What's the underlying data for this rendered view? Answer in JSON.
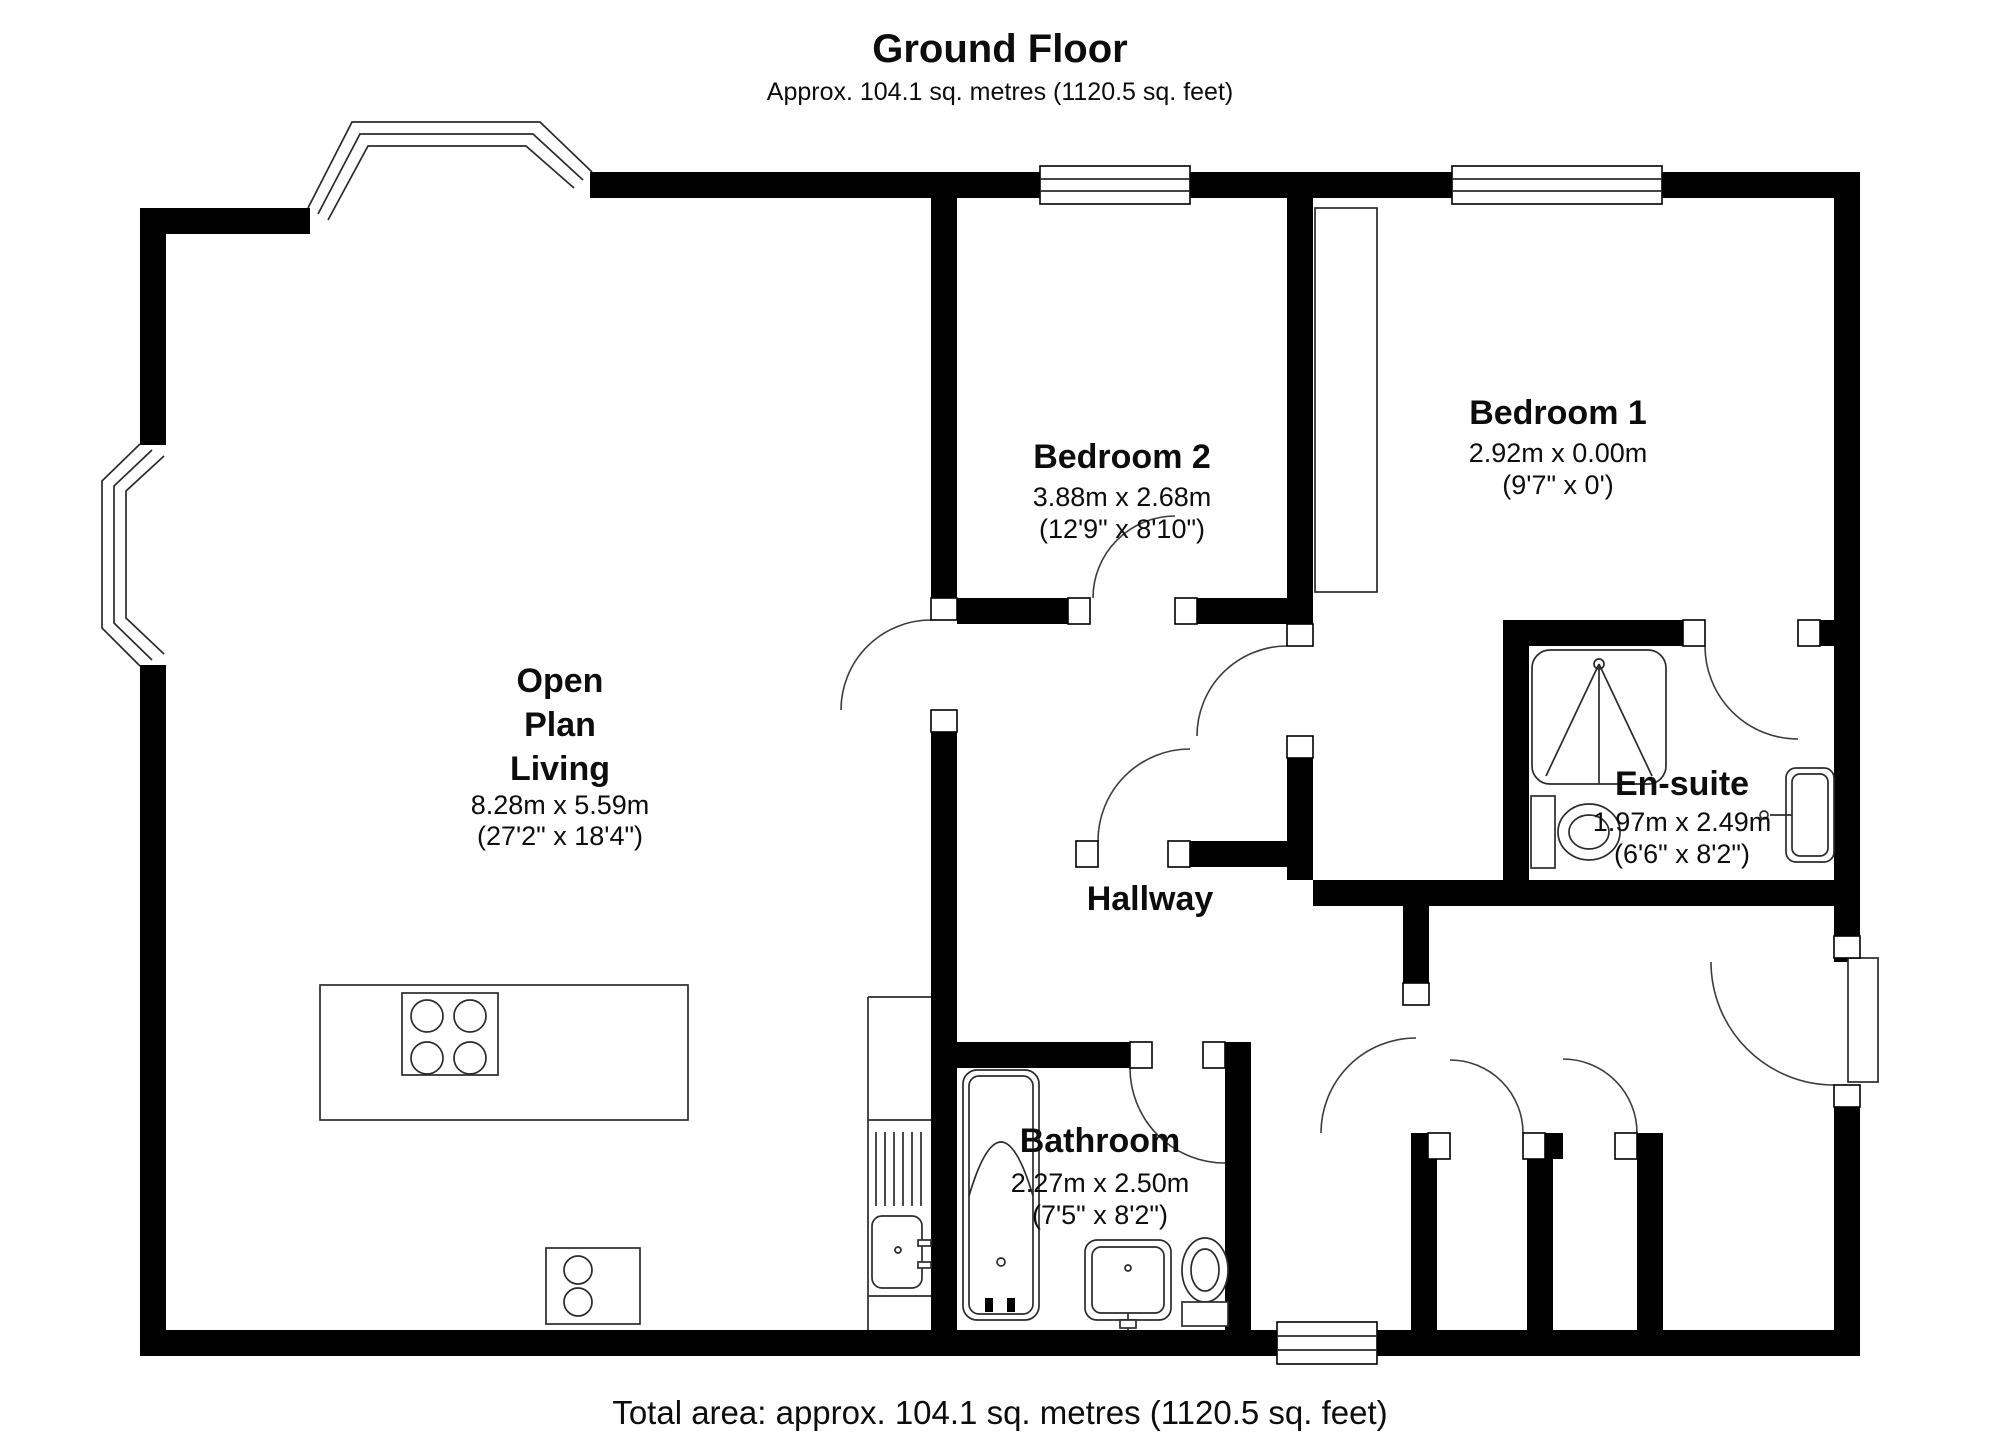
{
  "title": {
    "heading": "Ground Floor",
    "subtitle": "Approx. 104.1 sq. metres (1120.5 sq. feet)"
  },
  "footer": {
    "total_area": "Total area: approx. 104.1 sq. metres (1120.5 sq. feet)"
  },
  "rooms": {
    "open_plan_living": {
      "name_line1": "Open",
      "name_line2": "Plan",
      "name_line3": "Living",
      "dims_metric": "8.28m x 5.59m",
      "dims_imperial": "(27'2\" x 18'4\")"
    },
    "bedroom2": {
      "name": "Bedroom 2",
      "dims_metric": "3.88m x 2.68m",
      "dims_imperial": "(12'9\" x 8'10\")"
    },
    "bedroom1": {
      "name": "Bedroom 1",
      "dims_metric": "2.92m x 0.00m",
      "dims_imperial": "(9'7\" x 0')"
    },
    "ensuite": {
      "name": "En-suite",
      "dims_metric": "1.97m x 2.49m",
      "dims_imperial": "(6'6\" x 8'2\")"
    },
    "hallway": {
      "name": "Hallway"
    },
    "bathroom": {
      "name": "Bathroom",
      "dims_metric": "2.27m x 2.50m",
      "dims_imperial": "(7'5\" x 8'2\")"
    }
  },
  "colors": {
    "wall": "#000000",
    "background": "#ffffff",
    "fixture_line": "#2b2b2b"
  }
}
